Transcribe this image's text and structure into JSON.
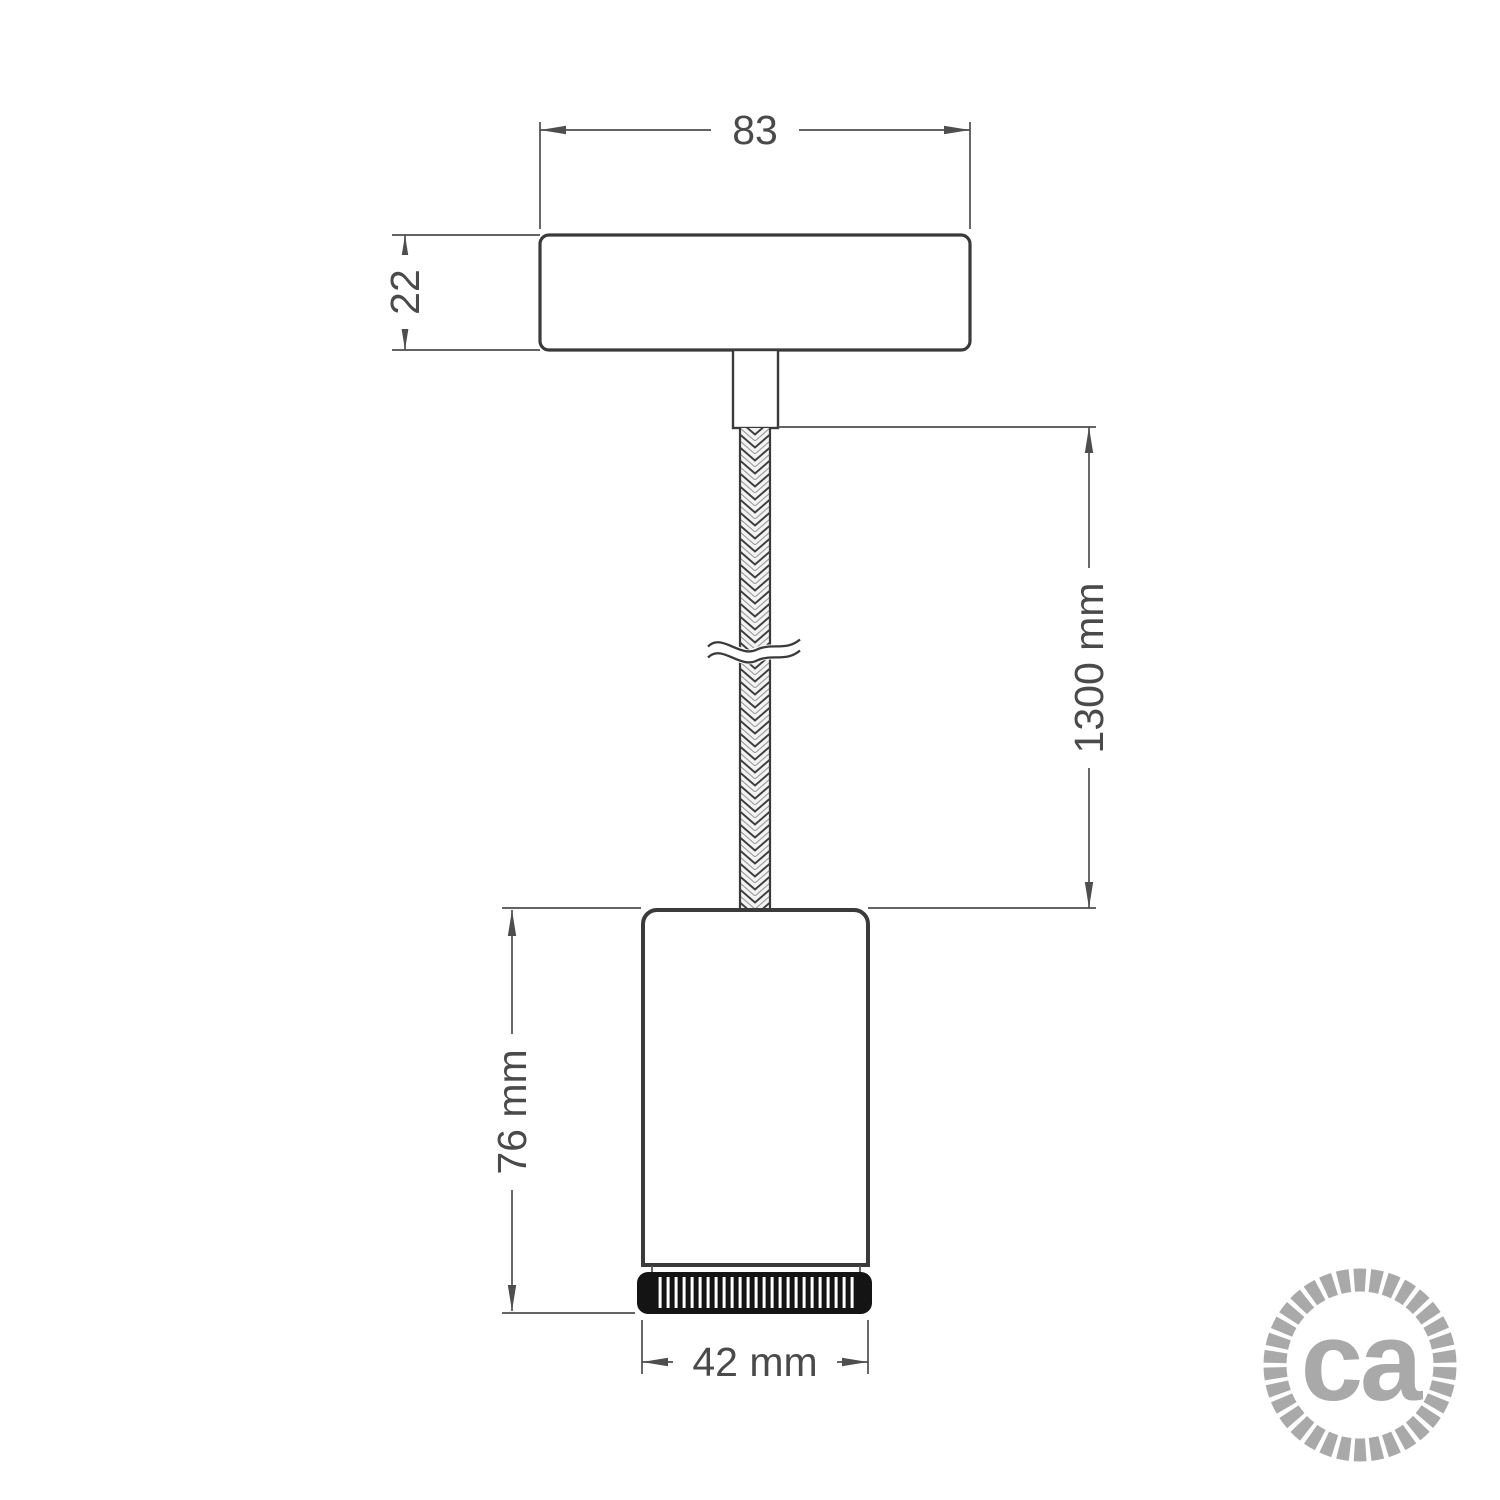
{
  "dimensions": {
    "canopy_width": "83",
    "canopy_height": "22",
    "cable_length": "1300 mm",
    "spot_height": "76 mm",
    "spot_diameter": "42 mm"
  },
  "logo": {
    "text": "ca"
  },
  "colors": {
    "part_outline": "#3a3a3a",
    "dimension_lines": "#4e4e4e",
    "dimension_text": "#4a4a4a",
    "cable_fill": "#f3f3f3",
    "ring_fill": "#141414",
    "logo_gray": "#a9a9a9",
    "background": "#ffffff"
  }
}
